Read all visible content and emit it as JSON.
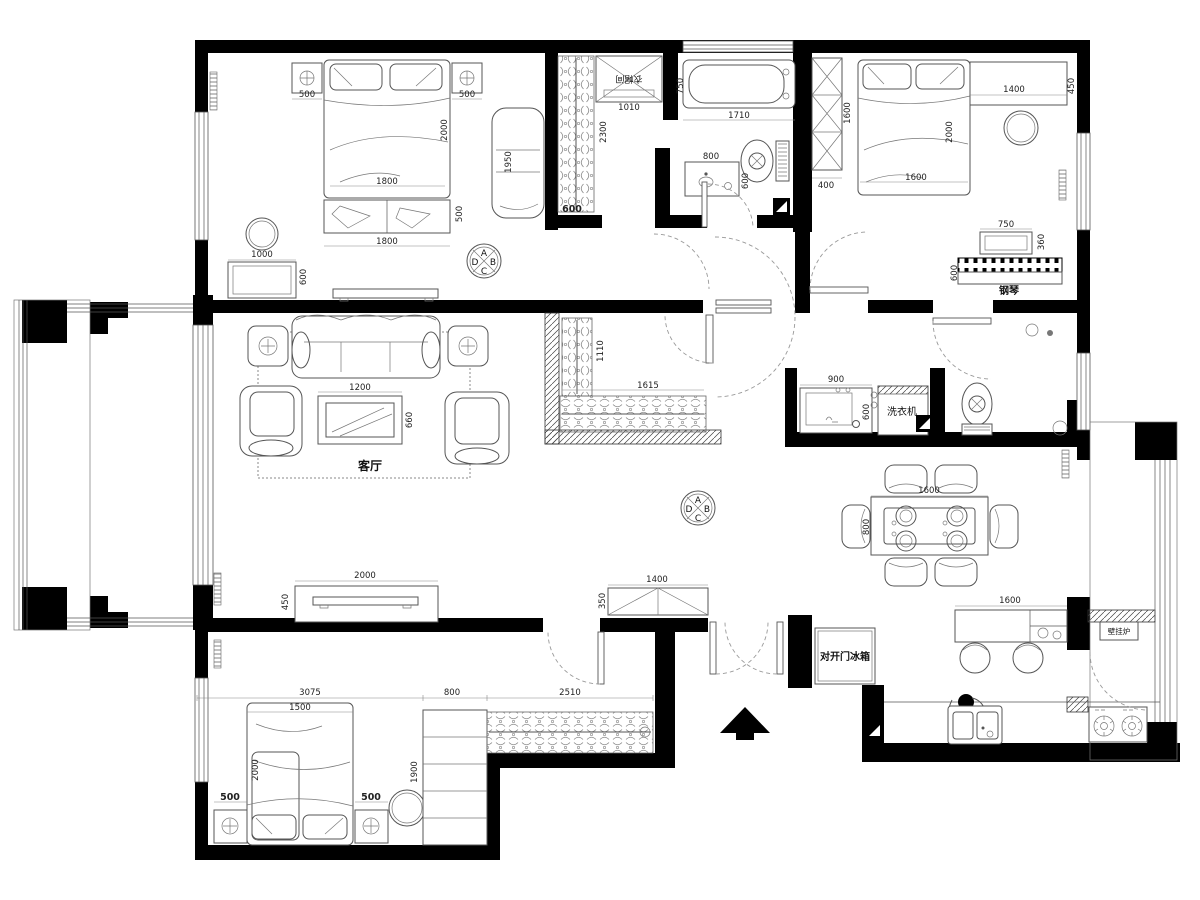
{
  "labels": {
    "living": "客厅",
    "closet": "衣帽间",
    "washer": "洗衣机",
    "piano": "钢琴",
    "fridge": "对开门冰箱",
    "boiler": "壁挂炉"
  },
  "compass": {
    "a": "A",
    "b": "B",
    "c": "C",
    "d": "D"
  },
  "dims": {
    "b1_ns_l": "500",
    "b1_ns_r": "500",
    "b1_bed_len": "2000",
    "b1_bed_w": "1800",
    "b1_chaise": "1950",
    "b1_bench_w": "1800",
    "b1_bench_d": "500",
    "b1_dresser_w": "1000",
    "b1_dresser_d": "600",
    "wic_cab_w": "1010",
    "wic_depth": "2300",
    "wic_rod_w": "600",
    "bt_tub_w": "750",
    "bt_tub_l": "1710",
    "bt_sink_w": "800",
    "bt_sink_d": "600",
    "b2_ward_w": "400",
    "b2_ward_h": "1600",
    "b2_shelf_w": "1400",
    "b2_shelf_d": "450",
    "b2_bed_len": "2000",
    "b2_bed_w": "1600",
    "pi_bench_w": "750",
    "pi_bench_d": "360",
    "pi_d": "600",
    "lr_ct_w": "1200",
    "lr_ct_d": "660",
    "lr_tv_w": "2000",
    "lr_tv_d": "450",
    "hc_d": "1110",
    "hc_w": "1615",
    "b2b_sink_w": "900",
    "b2b_sink_d": "600",
    "din_w": "1600",
    "din_d": "800",
    "ki_island": "1600",
    "en_shoe_w": "1400",
    "en_shoe_d": "350",
    "b3_room_w": "3075",
    "b3_bed_w": "1500",
    "b3_bed_len": "2000",
    "b3_ns_l": "500",
    "b3_ns_r": "500",
    "b3_shelf_w": "800",
    "b3_shelf_len": "1900",
    "b3_ward_w": "2510"
  }
}
